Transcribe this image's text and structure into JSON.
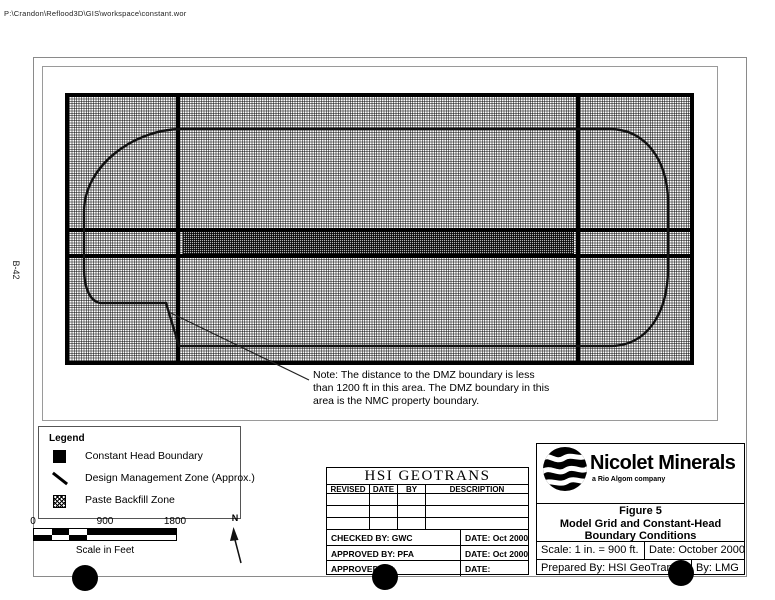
{
  "colors": {
    "ink": "#000000",
    "paper": "#ffffff"
  },
  "header": {
    "path_text": "P:\\Crandon\\Reflood3D\\GIS\\workspace\\constant.wor"
  },
  "side_label": "B-42",
  "note": {
    "lines": [
      "Note:  The distance to the DMZ boundary is less",
      "than 1200 ft in this area.  The DMZ boundary in this",
      "area is the NMC property boundary."
    ]
  },
  "legend": {
    "title": "Legend",
    "items": [
      {
        "symbol": "filled-square",
        "label": "Constant Head Boundary"
      },
      {
        "symbol": "diagonal-line",
        "label": "Design Management Zone (Approx.)"
      },
      {
        "symbol": "hatched-square",
        "label": "Paste Backfill Zone"
      }
    ]
  },
  "scale_bar": {
    "ticks": [
      "0",
      "900",
      "1800"
    ],
    "caption": "Scale in Feet"
  },
  "north": {
    "label": "N"
  },
  "revision_block": {
    "title": "HSI GEOTRANS",
    "columns": [
      "REVISED",
      "DATE",
      "BY",
      "DESCRIPTION"
    ],
    "rows": [
      {
        "left": "CHECKED BY:  GWC",
        "right": "DATE:  Oct 2000"
      },
      {
        "left": "APPROVED BY:  PFA",
        "right": "DATE:  Oct 2000"
      },
      {
        "left": "APPROVED BY:",
        "right": "DATE:"
      }
    ]
  },
  "title_block": {
    "company": "Nicolet Minerals",
    "company_sub": "a Rio Algom company",
    "figure_no": "Figure 5",
    "figure_title_line1": "Model Grid and Constant-Head",
    "figure_title_line2": "Boundary Conditions",
    "scale": "Scale: 1 in. = 900 ft.",
    "date": "Date: October 2000",
    "prepared_by": "Prepared By:  HSI GeoTrans",
    "by": "By:  LMG"
  }
}
